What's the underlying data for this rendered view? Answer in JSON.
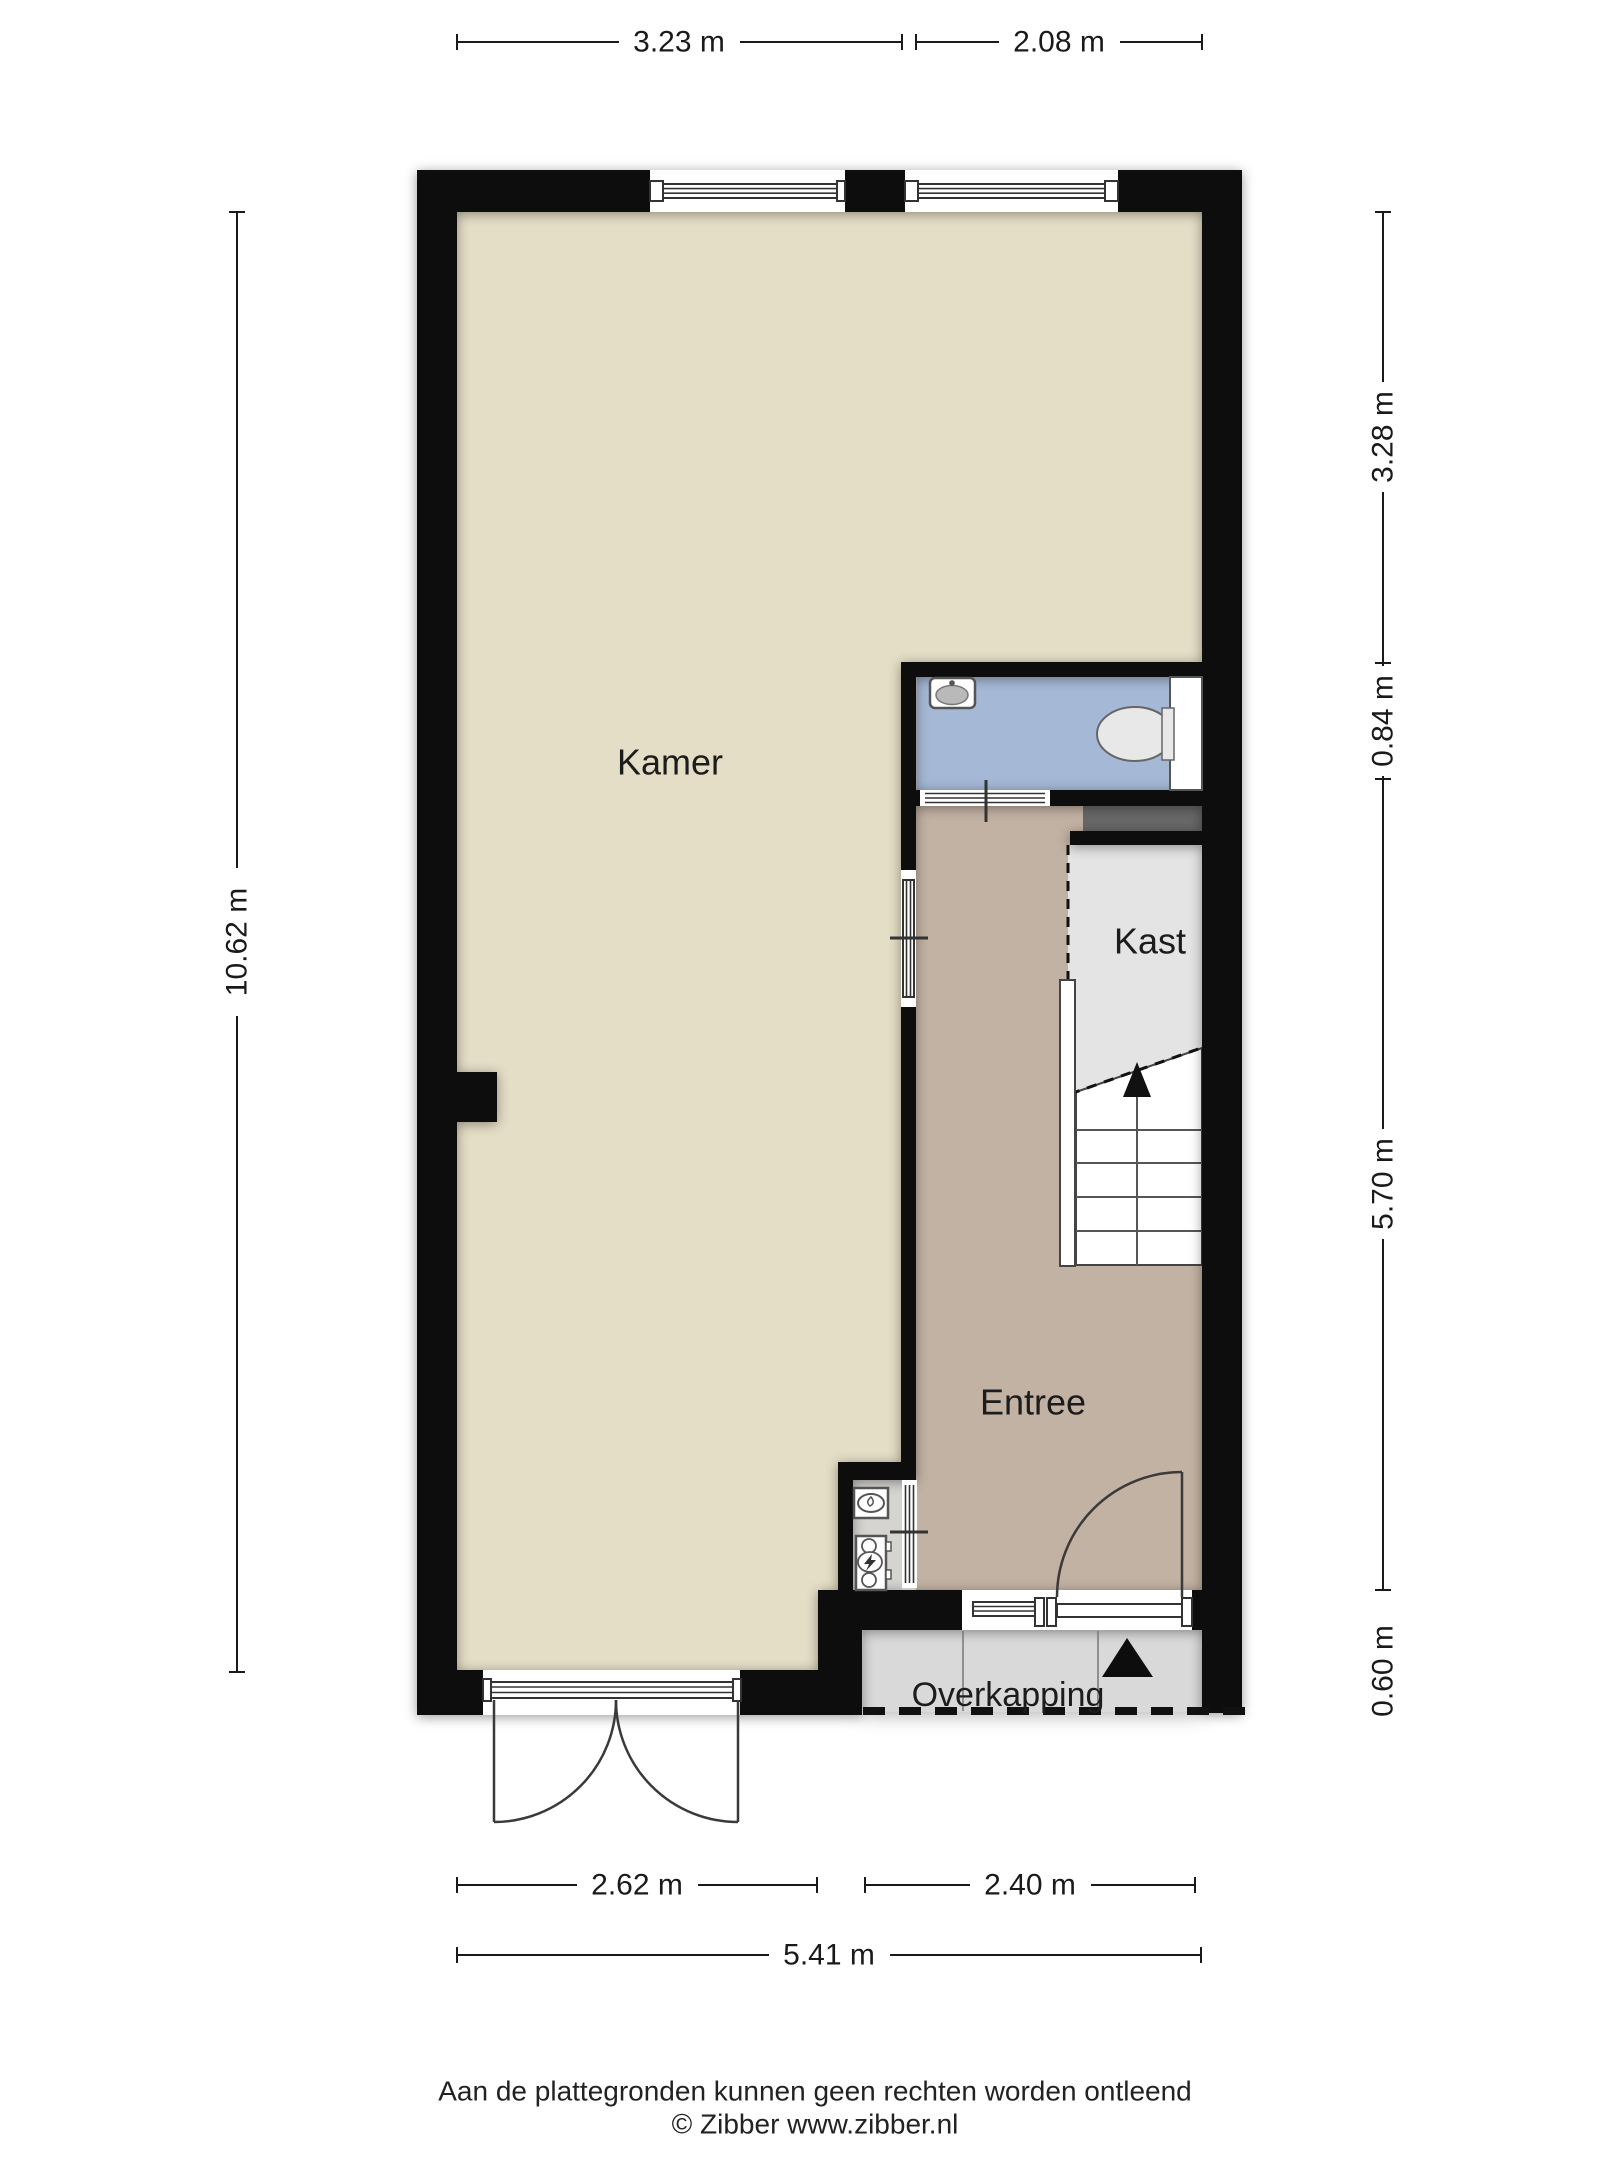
{
  "plan": {
    "rooms": [
      {
        "id": "kamer",
        "label": "Kamer"
      },
      {
        "id": "entree",
        "label": "Entree"
      },
      {
        "id": "kast",
        "label": "Kast"
      },
      {
        "id": "overkapping",
        "label": "Overkapping"
      }
    ],
    "icons": {
      "sink-icon": "oval-basin-with-tap",
      "toilet-icon": "bowl-ellipse-with-cistern",
      "boiler-icon": "oval-in-box",
      "electric-meter-icon": "circles-with-bolt-in-box",
      "stairs-up-arrow-icon": "triangle-up",
      "entrance-arrow-icon": "triangle-up"
    }
  },
  "dimensions": {
    "top": [
      {
        "label": "3.23 m"
      },
      {
        "label": "2.08 m"
      }
    ],
    "left": [
      {
        "label": "10.62 m"
      }
    ],
    "right": [
      {
        "label": "3.28 m"
      },
      {
        "label": "0.84 m"
      },
      {
        "label": "5.70 m"
      },
      {
        "label": "0.60 m"
      }
    ],
    "bottom": [
      {
        "label": "2.62 m"
      },
      {
        "label": "2.40 m"
      }
    ],
    "overall": [
      {
        "label": "5.41 m"
      }
    ]
  },
  "footer": {
    "disclaimer": "Aan de plattegronden kunnen geen rechten worden ontleend",
    "copyright": "© Zibber www.zibber.nl"
  },
  "colors": {
    "kamer": "#e5dec6",
    "entree": "#c2b2a3",
    "badkamer": "#a5b8d6",
    "kast": "#e4e4e4",
    "meterkast": "#d6d4d1",
    "overkapping": "#d9d9d9",
    "niche": "#686868",
    "wall": "#0d0d0d",
    "line": "#1a1a1a",
    "fixture": "#555555",
    "sinkbasin": "#b9b9b9",
    "toilet": "#e8e8e8"
  }
}
